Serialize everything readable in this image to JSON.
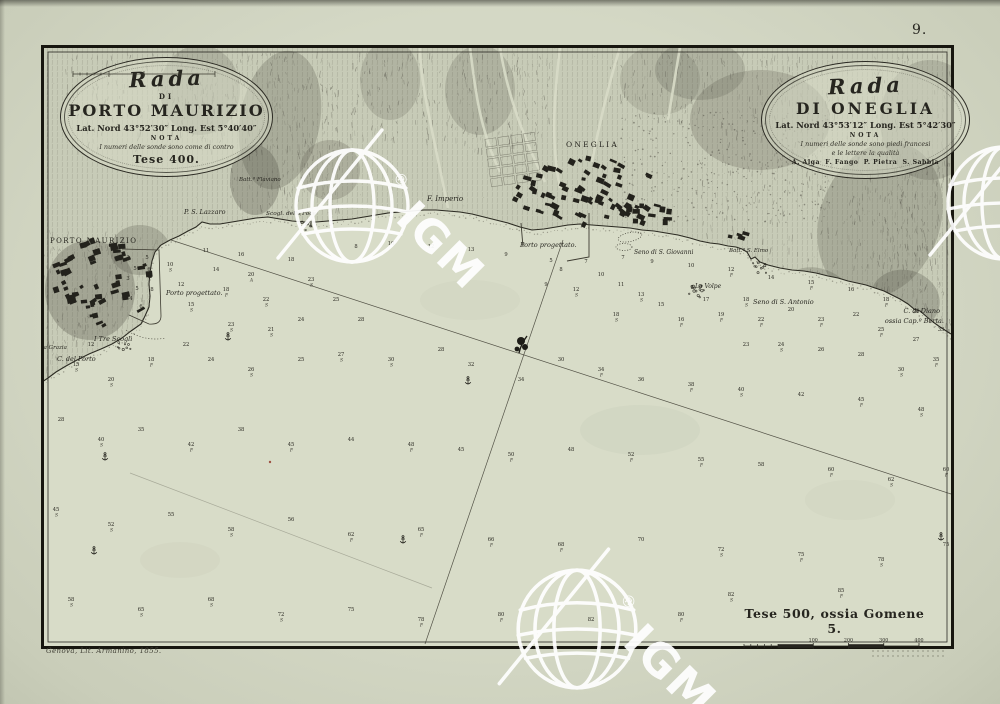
{
  "page": {
    "number": "9.",
    "imprint": "Genova, Lit. Armanino, 1855."
  },
  "cartouches": {
    "left": {
      "script_title": "Rada",
      "di": "DI",
      "title": "PORTO MAURIZIO",
      "coords": "Lat. Nord 43°52′30″ Long. Est 5°40′40″",
      "nota_label": "NOTA",
      "nota": "I numeri delle sonde sono come di contro",
      "scale_caption": "Tese 400."
    },
    "right": {
      "script_title": "Rada",
      "title": "DI ONEGLIA",
      "coords": "Lat. Nord 43°53′12″ Long. Est 5°42′30″",
      "nota_label": "NOTA",
      "nota1": "I numeri delle sonde sono piedi francesi",
      "nota2": "e le lettere la qualità",
      "legend": "A. Alga  F. Fango  P. Pietra  S. Sabbia"
    }
  },
  "scalebar": {
    "caption": "Tese 500, ossia Gomene 5.",
    "ticks": [
      "100",
      "200",
      "300",
      "400",
      "500"
    ]
  },
  "watermark": {
    "text": "IGM",
    "reg": "®"
  },
  "watermarks": [
    {
      "x": 352,
      "y": 206,
      "s": 1
    },
    {
      "x": 577,
      "y": 629,
      "s": 1.05
    },
    {
      "x": 1004,
      "y": 203,
      "s": 1
    }
  ],
  "labels": [
    {
      "text": "PORTO MAURIZIO",
      "x": 50,
      "y": 243,
      "cls": "town",
      "fs": 7,
      "ls": 1.4
    },
    {
      "text": "ONEGLIA",
      "x": 566,
      "y": 147,
      "cls": "town",
      "fs": 7.5,
      "ls": 2.2
    },
    {
      "text": "P. S. Lazzaro",
      "x": 184,
      "y": 214,
      "cls": "it",
      "fs": 6.5
    },
    {
      "text": "Batt.ª Flaviano",
      "x": 239,
      "y": 181,
      "cls": "it",
      "fs": 5.5
    },
    {
      "text": "Scogl. della Foce",
      "x": 266,
      "y": 215,
      "cls": "it",
      "fs": 5.8
    },
    {
      "text": "F. Imperio",
      "x": 427,
      "y": 201,
      "cls": "it",
      "fs": 7
    },
    {
      "text": "Porto progettato.",
      "x": 520,
      "y": 247,
      "cls": "it",
      "fs": 6.5
    },
    {
      "text": "Seno di S. Giovanni",
      "x": 634,
      "y": 254,
      "cls": "it",
      "fs": 6
    },
    {
      "text": "Batt.ª S. Elmo",
      "x": 729,
      "y": 252,
      "cls": "it",
      "fs": 5.5
    },
    {
      "text": "La Volpe",
      "x": 695,
      "y": 288,
      "cls": "it",
      "fs": 6
    },
    {
      "text": "Seno di S. Antonio",
      "x": 753,
      "y": 304,
      "cls": "it",
      "fs": 6.5
    },
    {
      "text": "C. di Diano",
      "x": 940,
      "y": 313,
      "cls": "it",
      "fs": 6.5,
      "anchor": "end"
    },
    {
      "text": "ossia Cap.º Berta.",
      "x": 944,
      "y": 323,
      "cls": "it",
      "fs": 6.5,
      "anchor": "end"
    },
    {
      "text": "Porto progettato.",
      "x": 166,
      "y": 295,
      "cls": "it",
      "fs": 6.5
    },
    {
      "text": "I Tre Scogli",
      "x": 94,
      "y": 341,
      "cls": "it",
      "fs": 6.5
    },
    {
      "text": "La Grazia",
      "x": 40,
      "y": 349,
      "cls": "it",
      "fs": 5.5
    },
    {
      "text": "C. del Porto",
      "x": 57,
      "y": 361,
      "cls": "it",
      "fs": 6.5
    }
  ],
  "towns": [
    {
      "name": "porto-maurizio",
      "cx": 103,
      "cy": 284,
      "rx": 52,
      "ry": 44,
      "n": 55,
      "rot": -20,
      "seed": 7
    },
    {
      "name": "oneglia",
      "cx": 585,
      "cy": 191,
      "rx": 72,
      "ry": 34,
      "n": 68,
      "rot": 25,
      "seed": 11
    },
    {
      "name": "oneglia-marina",
      "cx": 652,
      "cy": 214,
      "rx": 32,
      "ry": 10,
      "n": 13,
      "rot": 15,
      "seed": 5
    },
    {
      "name": "borgo-est",
      "cx": 740,
      "cy": 236,
      "rx": 14,
      "ry": 6,
      "n": 4,
      "rot": 10,
      "seed": 3
    }
  ],
  "lines": [
    [
      171,
      240,
      997,
      509,
      0.85
    ],
    [
      563,
      240,
      425,
      644,
      0.85
    ],
    [
      130,
      473,
      432,
      588,
      0.3
    ]
  ],
  "rock_clusters": [
    {
      "x": 697,
      "y": 292,
      "n": 14,
      "r": 9
    },
    {
      "x": 124,
      "y": 347,
      "n": 8,
      "r": 7
    },
    {
      "x": 758,
      "y": 268,
      "n": 10,
      "r": 8
    },
    {
      "x": 308,
      "y": 226,
      "n": 7,
      "r": 6
    }
  ],
  "anchors": [
    [
      228,
      337
    ],
    [
      105,
      457
    ],
    [
      94,
      551
    ],
    [
      403,
      540
    ],
    [
      468,
      381
    ],
    [
      941,
      537
    ]
  ],
  "ink_blob": [
    521,
    344
  ],
  "red_speck": [
    270,
    462
  ],
  "soundings": [
    [
      128,
      259,
      "3",
      ""
    ],
    [
      135,
      270,
      "5",
      ""
    ],
    [
      128,
      280,
      "3",
      ""
    ],
    [
      137,
      290,
      "5",
      ""
    ],
    [
      131,
      300,
      "4",
      ""
    ],
    [
      141,
      308,
      "6",
      ""
    ],
    [
      149,
      271,
      "6",
      ""
    ],
    [
      152,
      291,
      "8",
      ""
    ],
    [
      147,
      259,
      "5",
      ""
    ],
    [
      170,
      266,
      "10",
      "S"
    ],
    [
      181,
      286,
      "12",
      ""
    ],
    [
      191,
      306,
      "15",
      "S"
    ],
    [
      206,
      252,
      "11",
      ""
    ],
    [
      216,
      271,
      "14",
      ""
    ],
    [
      226,
      291,
      "18",
      "F"
    ],
    [
      241,
      256,
      "16",
      ""
    ],
    [
      251,
      276,
      "20",
      "A"
    ],
    [
      266,
      301,
      "22",
      "S"
    ],
    [
      291,
      261,
      "18",
      ""
    ],
    [
      311,
      281,
      "23",
      "S"
    ],
    [
      336,
      301,
      "25",
      ""
    ],
    [
      301,
      321,
      "24",
      ""
    ],
    [
      271,
      331,
      "21",
      "S"
    ],
    [
      231,
      326,
      "23",
      "S"
    ],
    [
      361,
      321,
      "28",
      ""
    ],
    [
      356,
      248,
      "8",
      ""
    ],
    [
      391,
      245,
      "10",
      ""
    ],
    [
      431,
      248,
      "12",
      ""
    ],
    [
      471,
      251,
      "13",
      ""
    ],
    [
      506,
      256,
      "9",
      ""
    ],
    [
      551,
      262,
      "5",
      ""
    ],
    [
      561,
      271,
      "8",
      ""
    ],
    [
      586,
      263,
      "7",
      ""
    ],
    [
      601,
      276,
      "10",
      ""
    ],
    [
      576,
      291,
      "12",
      "S"
    ],
    [
      546,
      286,
      "9",
      ""
    ],
    [
      621,
      286,
      "11",
      ""
    ],
    [
      641,
      296,
      "13",
      "S"
    ],
    [
      661,
      306,
      "15",
      ""
    ],
    [
      616,
      316,
      "18",
      "S"
    ],
    [
      681,
      321,
      "16",
      "F"
    ],
    [
      623,
      259,
      "7",
      ""
    ],
    [
      652,
      263,
      "9",
      ""
    ],
    [
      691,
      267,
      "10",
      ""
    ],
    [
      731,
      271,
      "12",
      "F"
    ],
    [
      771,
      279,
      "14",
      ""
    ],
    [
      811,
      284,
      "15",
      "F"
    ],
    [
      851,
      291,
      "16",
      ""
    ],
    [
      886,
      301,
      "18",
      "F"
    ],
    [
      916,
      313,
      "20",
      ""
    ],
    [
      706,
      301,
      "17",
      ""
    ],
    [
      721,
      316,
      "19",
      "F"
    ],
    [
      746,
      301,
      "18",
      "S"
    ],
    [
      761,
      321,
      "22",
      "F"
    ],
    [
      791,
      311,
      "20",
      ""
    ],
    [
      821,
      321,
      "23",
      "F"
    ],
    [
      856,
      316,
      "22",
      ""
    ],
    [
      881,
      331,
      "25",
      "F"
    ],
    [
      916,
      341,
      "27",
      ""
    ],
    [
      941,
      331,
      "33",
      ""
    ],
    [
      936,
      361,
      "35",
      "F"
    ],
    [
      901,
      371,
      "30",
      "S"
    ],
    [
      861,
      356,
      "28",
      ""
    ],
    [
      821,
      351,
      "26",
      ""
    ],
    [
      781,
      346,
      "24",
      "S"
    ],
    [
      746,
      346,
      "23",
      ""
    ],
    [
      91,
      346,
      "12",
      ""
    ],
    [
      76,
      366,
      "15",
      "S"
    ],
    [
      111,
      381,
      "20",
      "S"
    ],
    [
      151,
      361,
      "18",
      "F"
    ],
    [
      186,
      346,
      "22",
      ""
    ],
    [
      211,
      361,
      "24",
      ""
    ],
    [
      251,
      371,
      "26",
      "S"
    ],
    [
      301,
      361,
      "25",
      ""
    ],
    [
      341,
      356,
      "27",
      "S"
    ],
    [
      391,
      361,
      "30",
      "S"
    ],
    [
      441,
      351,
      "28",
      ""
    ],
    [
      471,
      366,
      "32",
      ""
    ],
    [
      521,
      381,
      "34",
      ""
    ],
    [
      561,
      361,
      "30",
      ""
    ],
    [
      601,
      371,
      "34",
      "F"
    ],
    [
      641,
      381,
      "36",
      ""
    ],
    [
      691,
      386,
      "38",
      "F"
    ],
    [
      741,
      391,
      "40",
      "S"
    ],
    [
      801,
      396,
      "42",
      ""
    ],
    [
      861,
      401,
      "45",
      "F"
    ],
    [
      921,
      411,
      "48",
      "S"
    ],
    [
      956,
      391,
      "45",
      ""
    ],
    [
      61,
      421,
      "28",
      ""
    ],
    [
      101,
      441,
      "40",
      "S"
    ],
    [
      141,
      431,
      "35",
      ""
    ],
    [
      191,
      446,
      "42",
      "F"
    ],
    [
      241,
      431,
      "38",
      ""
    ],
    [
      291,
      446,
      "45",
      "F"
    ],
    [
      351,
      441,
      "44",
      ""
    ],
    [
      411,
      446,
      "48",
      "F"
    ],
    [
      461,
      451,
      "45",
      ""
    ],
    [
      511,
      456,
      "50",
      "F"
    ],
    [
      571,
      451,
      "48",
      ""
    ],
    [
      631,
      456,
      "52",
      "F"
    ],
    [
      701,
      461,
      "55",
      "F"
    ],
    [
      761,
      466,
      "58",
      ""
    ],
    [
      831,
      471,
      "60",
      "F"
    ],
    [
      891,
      481,
      "62",
      "S"
    ],
    [
      946,
      471,
      "60",
      "F"
    ],
    [
      56,
      511,
      "45",
      "S"
    ],
    [
      111,
      526,
      "52",
      "S"
    ],
    [
      171,
      516,
      "55",
      ""
    ],
    [
      231,
      531,
      "58",
      "S"
    ],
    [
      291,
      521,
      "56",
      ""
    ],
    [
      351,
      536,
      "62",
      "F"
    ],
    [
      421,
      531,
      "65",
      "F"
    ],
    [
      491,
      541,
      "66",
      "F"
    ],
    [
      561,
      546,
      "68",
      "F"
    ],
    [
      641,
      541,
      "70",
      ""
    ],
    [
      721,
      551,
      "72",
      "S"
    ],
    [
      801,
      556,
      "75",
      "F"
    ],
    [
      881,
      561,
      "78",
      "S"
    ],
    [
      946,
      546,
      "75",
      ""
    ],
    [
      71,
      601,
      "58",
      "S"
    ],
    [
      141,
      611,
      "65",
      "S"
    ],
    [
      211,
      601,
      "68",
      "S"
    ],
    [
      281,
      616,
      "72",
      "S"
    ],
    [
      351,
      611,
      "75",
      ""
    ],
    [
      421,
      621,
      "78",
      "F"
    ],
    [
      501,
      616,
      "80",
      "F"
    ],
    [
      591,
      621,
      "82",
      ""
    ],
    [
      681,
      616,
      "80",
      "F"
    ],
    [
      731,
      596,
      "82",
      "S"
    ],
    [
      841,
      592,
      "85",
      "F"
    ]
  ]
}
